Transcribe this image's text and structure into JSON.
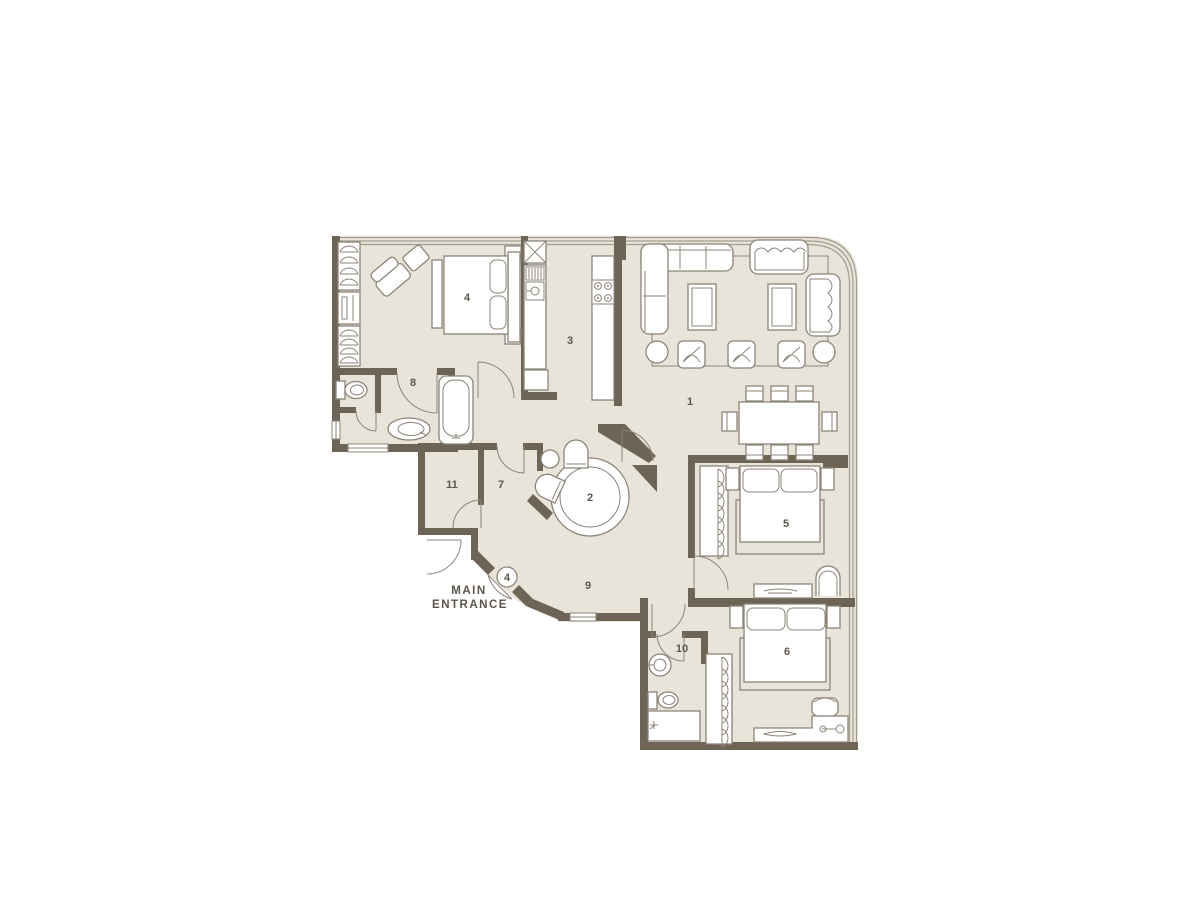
{
  "title": "Apartment floor plan",
  "colors": {
    "background": "#ffffff",
    "floor": "#e9e4da",
    "wall": "#6e6456",
    "furniture_line": "#8b8478",
    "glass_facade": "#a39d90",
    "text": "#5b554b"
  },
  "rooms": [
    {
      "id": "living-dining",
      "label": "1"
    },
    {
      "id": "round-hall",
      "label": "2"
    },
    {
      "id": "kitchen",
      "label": "3"
    },
    {
      "id": "bedroom-master",
      "label": "4"
    },
    {
      "id": "bedroom-second",
      "label": "5"
    },
    {
      "id": "bedroom-third",
      "label": "6"
    },
    {
      "id": "hallway",
      "label": "7"
    },
    {
      "id": "bathroom-main",
      "label": "8"
    },
    {
      "id": "corridor",
      "label": "9"
    },
    {
      "id": "bathroom-second",
      "label": "10"
    },
    {
      "id": "closet",
      "label": "11"
    }
  ],
  "entrance": {
    "badge": "4",
    "label_line1": "MAIN",
    "label_line2": "ENTRANCE"
  },
  "furniture_symbols": [
    "sectional-sofa",
    "loveseat",
    "sofa",
    "armchair",
    "coffee-table",
    "round-side-table",
    "dining-table-8-chairs",
    "round-table",
    "double-bed",
    "nightstand",
    "wardrobe-hangers",
    "dressing-mirror",
    "vanity-desk",
    "desk-with-chair",
    "bathtub",
    "toilet",
    "sink",
    "shower-tray",
    "refrigerator",
    "kitchen-sink",
    "stove-4-burners"
  ]
}
